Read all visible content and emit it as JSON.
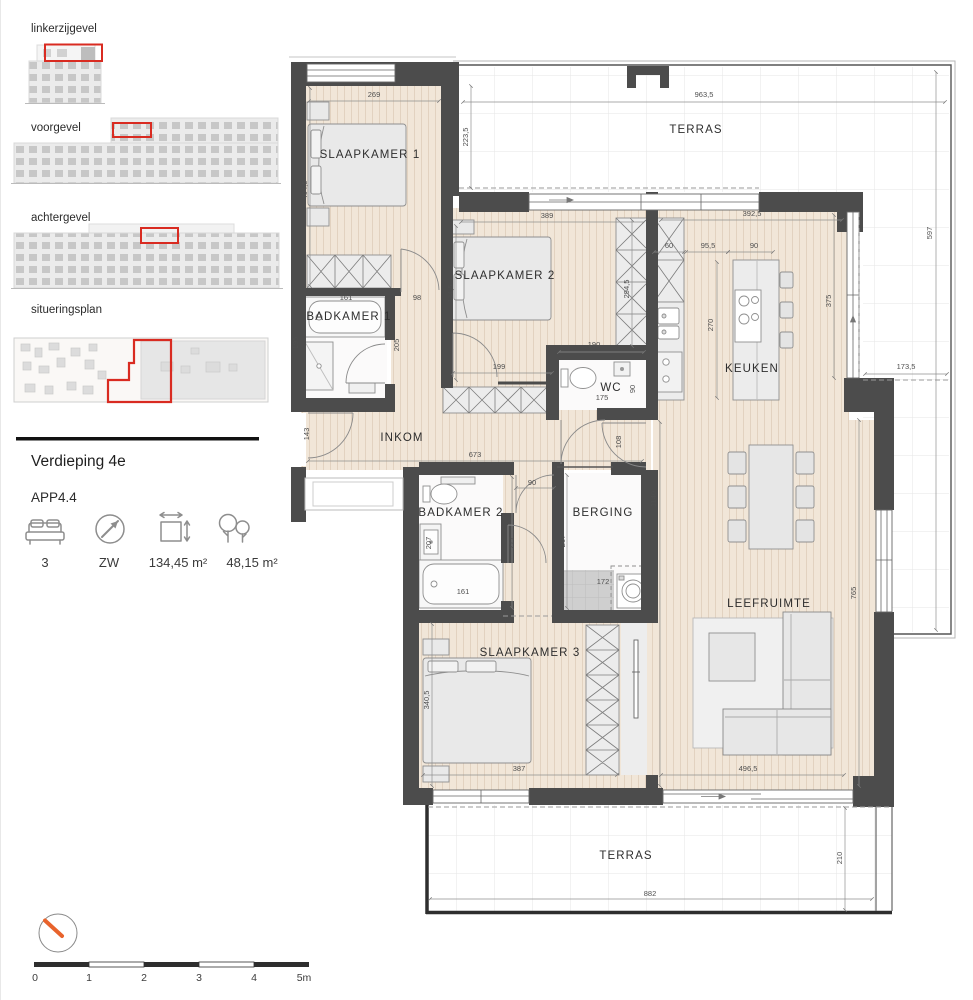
{
  "sidebar": {
    "sections": [
      {
        "label": "linkerzijgevel"
      },
      {
        "label": "voorgevel"
      },
      {
        "label": "achtergevel"
      },
      {
        "label": "situeringsplan"
      }
    ],
    "floor_title": "Verdieping 4e",
    "apartment_id": "APP4.4",
    "stats": [
      {
        "icon": "bed-icon",
        "value": "3"
      },
      {
        "icon": "compass-icon",
        "value": "ZW"
      },
      {
        "icon": "area-icon",
        "value": "134,45 m²"
      },
      {
        "icon": "terrace-area-icon",
        "value": "48,15 m²"
      }
    ],
    "highlight_color": "#d92b21"
  },
  "plan": {
    "colors": {
      "wall": "#4c4c4c",
      "floor": "#f1e6d8",
      "accent": "#d92b21",
      "compass_needle": "#e8632c"
    },
    "rooms": {
      "slaapkamer1": "SLAAPKAMER 1",
      "slaapkamer2": "SLAAPKAMER 2",
      "slaapkamer3": "SLAAPKAMER 3",
      "badkamer1": "BADKAMER 1",
      "badkamer2": "BADKAMER 2",
      "wc": "WC",
      "inkom": "INKOM",
      "keuken": "KEUKEN",
      "berging": "BERGING",
      "leefruimte": "LEEFRUIMTE",
      "terras_top": "TERRAS",
      "terras_bottom": "TERRAS"
    },
    "dims": {
      "sk1_w": "269",
      "sk1_h": "404,5",
      "terras_top_left_h": "223,5",
      "terras_top_w": "963,5",
      "sk2_w": "389",
      "sk2_h": "334,5",
      "keuken_w": "392,5",
      "kast_keuken": "60",
      "eiland_off": "95,5",
      "eiland_w": "90",
      "kast_sk2_h": "294,5",
      "eiland_h": "270",
      "keuken_glas": "375",
      "terras_right_h": "597",
      "terras_right_w": "173,5",
      "bad1_w": "161",
      "hal1_w": "98",
      "douche": "195",
      "hal1_h": "205",
      "pass199": "199",
      "wc_wall": "190",
      "wc_w": "175",
      "wc_h": "90",
      "voordeur": "143",
      "inkom_w": "673",
      "pass108": "108",
      "bad2_deur": "90",
      "corridor_h": "1140",
      "lavabo": "207",
      "gang_bad2": "277",
      "berging_h": "267",
      "bad2_bad": "161",
      "wasmachine": "172",
      "sk3_h": "340,5",
      "sk3_w": "387",
      "leef_w": "496,5",
      "leef_h": "765",
      "terras_b_w": "882",
      "terras_b_h": "210"
    }
  },
  "scalebar": {
    "labels": [
      "0",
      "1",
      "2",
      "3",
      "4",
      "5m"
    ]
  }
}
